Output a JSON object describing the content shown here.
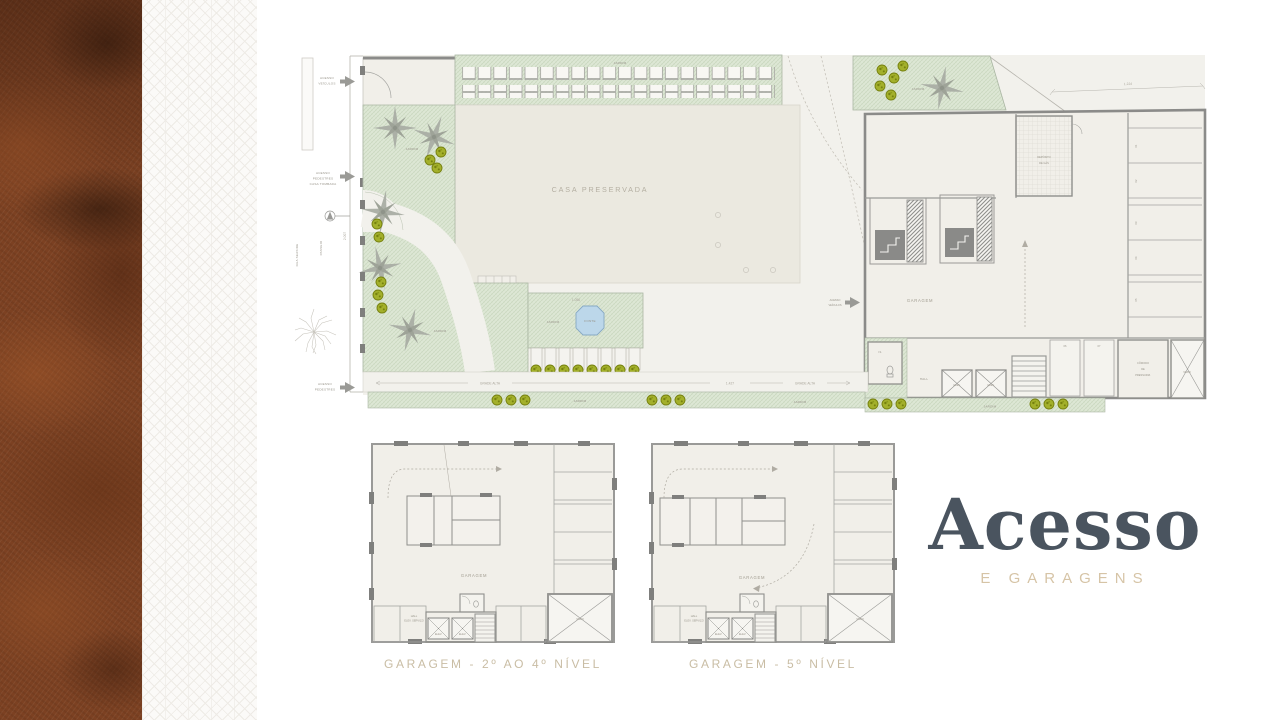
{
  "title": {
    "main": "Acesso",
    "subtitle": "E GARAGENS"
  },
  "site": {
    "casa": "CASA PRESERVADA",
    "jardim": "JARDIM",
    "fonte": "FONTE",
    "garagem": "GARAGEM",
    "hall": "HALL",
    "elev": "ELEV.",
    "is_label": "I.S.",
    "deposito": [
      "DEPÓSITO",
      "DE GÁS"
    ],
    "comodo": [
      "CÔMODO",
      "DE",
      "PRESSURIZ."
    ],
    "vazio": "VAZIO",
    "acesso_veiculos": [
      "ACESSO",
      "VEÍCULOS"
    ],
    "acesso_pedestres_casa": [
      "ACESSO",
      "PEDESTRES",
      "CASA TOMBADA"
    ],
    "acesso_pedestres": [
      "ACESSO",
      "PEDESTRES"
    ],
    "rua": "RUA SEASIDE",
    "passeio": "PASSEIO",
    "grade_alta": "GRADE ALTA",
    "dims": {
      "top": "1.224",
      "bottom": "1.427",
      "left": "2.007",
      "fountain": "1.056"
    },
    "spots": [
      "01",
      "02",
      "03",
      "04",
      "05",
      "06",
      "07"
    ]
  },
  "plans": {
    "garagem": "GARAGEM",
    "elev": "ELEV.",
    "vazio": "VAZIO",
    "hall": [
      "HALL",
      "ELEV. SERVIÇO"
    ],
    "p1": {
      "caption": "GARAGEM - 2º AO 4º NÍVEL"
    },
    "p2": {
      "caption": "GARAGEM - 5º NÍVEL"
    }
  }
}
